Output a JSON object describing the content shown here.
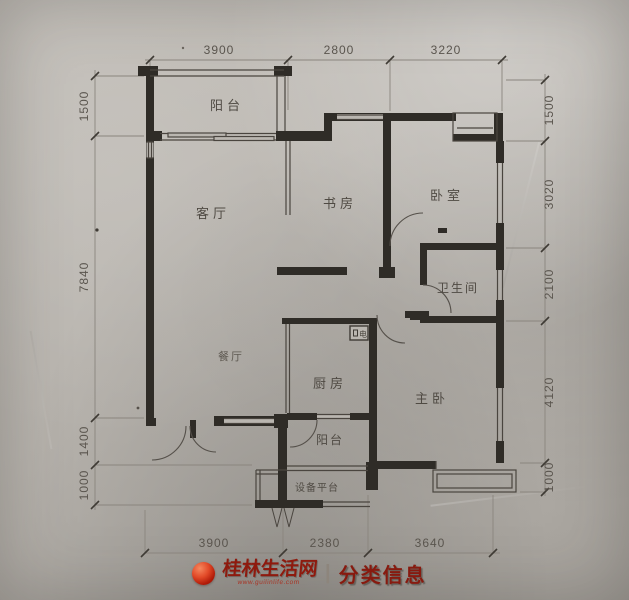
{
  "floorplan": {
    "rooms": {
      "balcony_top": "阳台",
      "living": "客厅",
      "study": "书房",
      "bedroom": "卧室",
      "bathroom": "卫生间",
      "dining": "餐厅",
      "kitchen": "厨房",
      "master": "主卧",
      "balcony_bottom": "阳台",
      "equipment": "设备平台",
      "electric_box": "电"
    },
    "dimensions": {
      "top": [
        "3900",
        "2800",
        "3220"
      ],
      "bottom": [
        "3900",
        "2380",
        "3640"
      ],
      "left": [
        "1500",
        "7840",
        "1400",
        "1000"
      ],
      "right": [
        "1500",
        "3020",
        "2100",
        "4120",
        "1000"
      ]
    }
  },
  "watermark": {
    "site": "桂林生活网",
    "url": "www.guilinlife.com",
    "divider": "|",
    "section": "分类信息"
  },
  "colors": {
    "paper": "#b7b3ad",
    "wall": "#2f2c27",
    "thin_line": "#55504a",
    "dim_text": "#5a554e",
    "watermark_red": "#8e1a0e"
  }
}
